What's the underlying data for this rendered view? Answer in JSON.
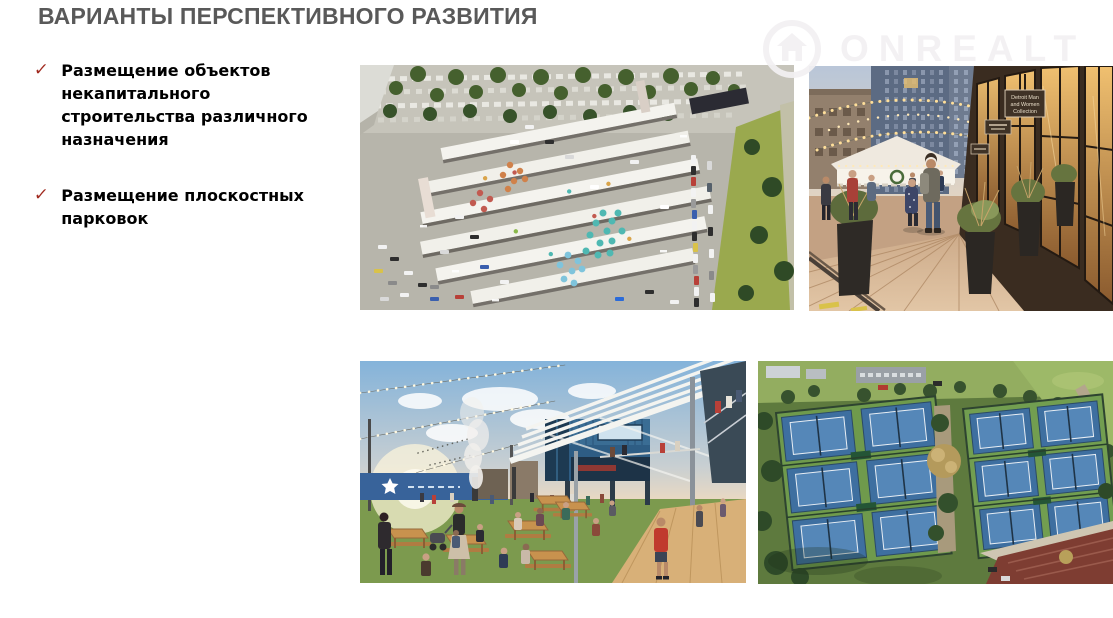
{
  "theme": {
    "background": "#ffffff",
    "title-color": "#595959",
    "text-color": "#000000",
    "check-color": "#A12B20",
    "watermark-color": "rgba(242,240,242,0.92)"
  },
  "slide": {
    "title": "ВАРИАНТЫ ПЕРСПЕКТИВНОГО РАЗВИТИЯ",
    "bullets": [
      {
        "marker": "✓",
        "text": "Размещение объектов некапитального строительства различного назначения"
      },
      {
        "marker": "✓",
        "text": "Размещение плоскостных парковок"
      }
    ]
  },
  "watermark": {
    "text": "ONREALT",
    "icon": "house-in-circle"
  },
  "photos": [
    {
      "id": "market-aerial"
    },
    {
      "id": "street-walkway",
      "sign_lines": [
        "Detroit Man",
        "and Women",
        "Collection"
      ]
    },
    {
      "id": "food-court"
    },
    {
      "id": "tennis-courts"
    }
  ]
}
